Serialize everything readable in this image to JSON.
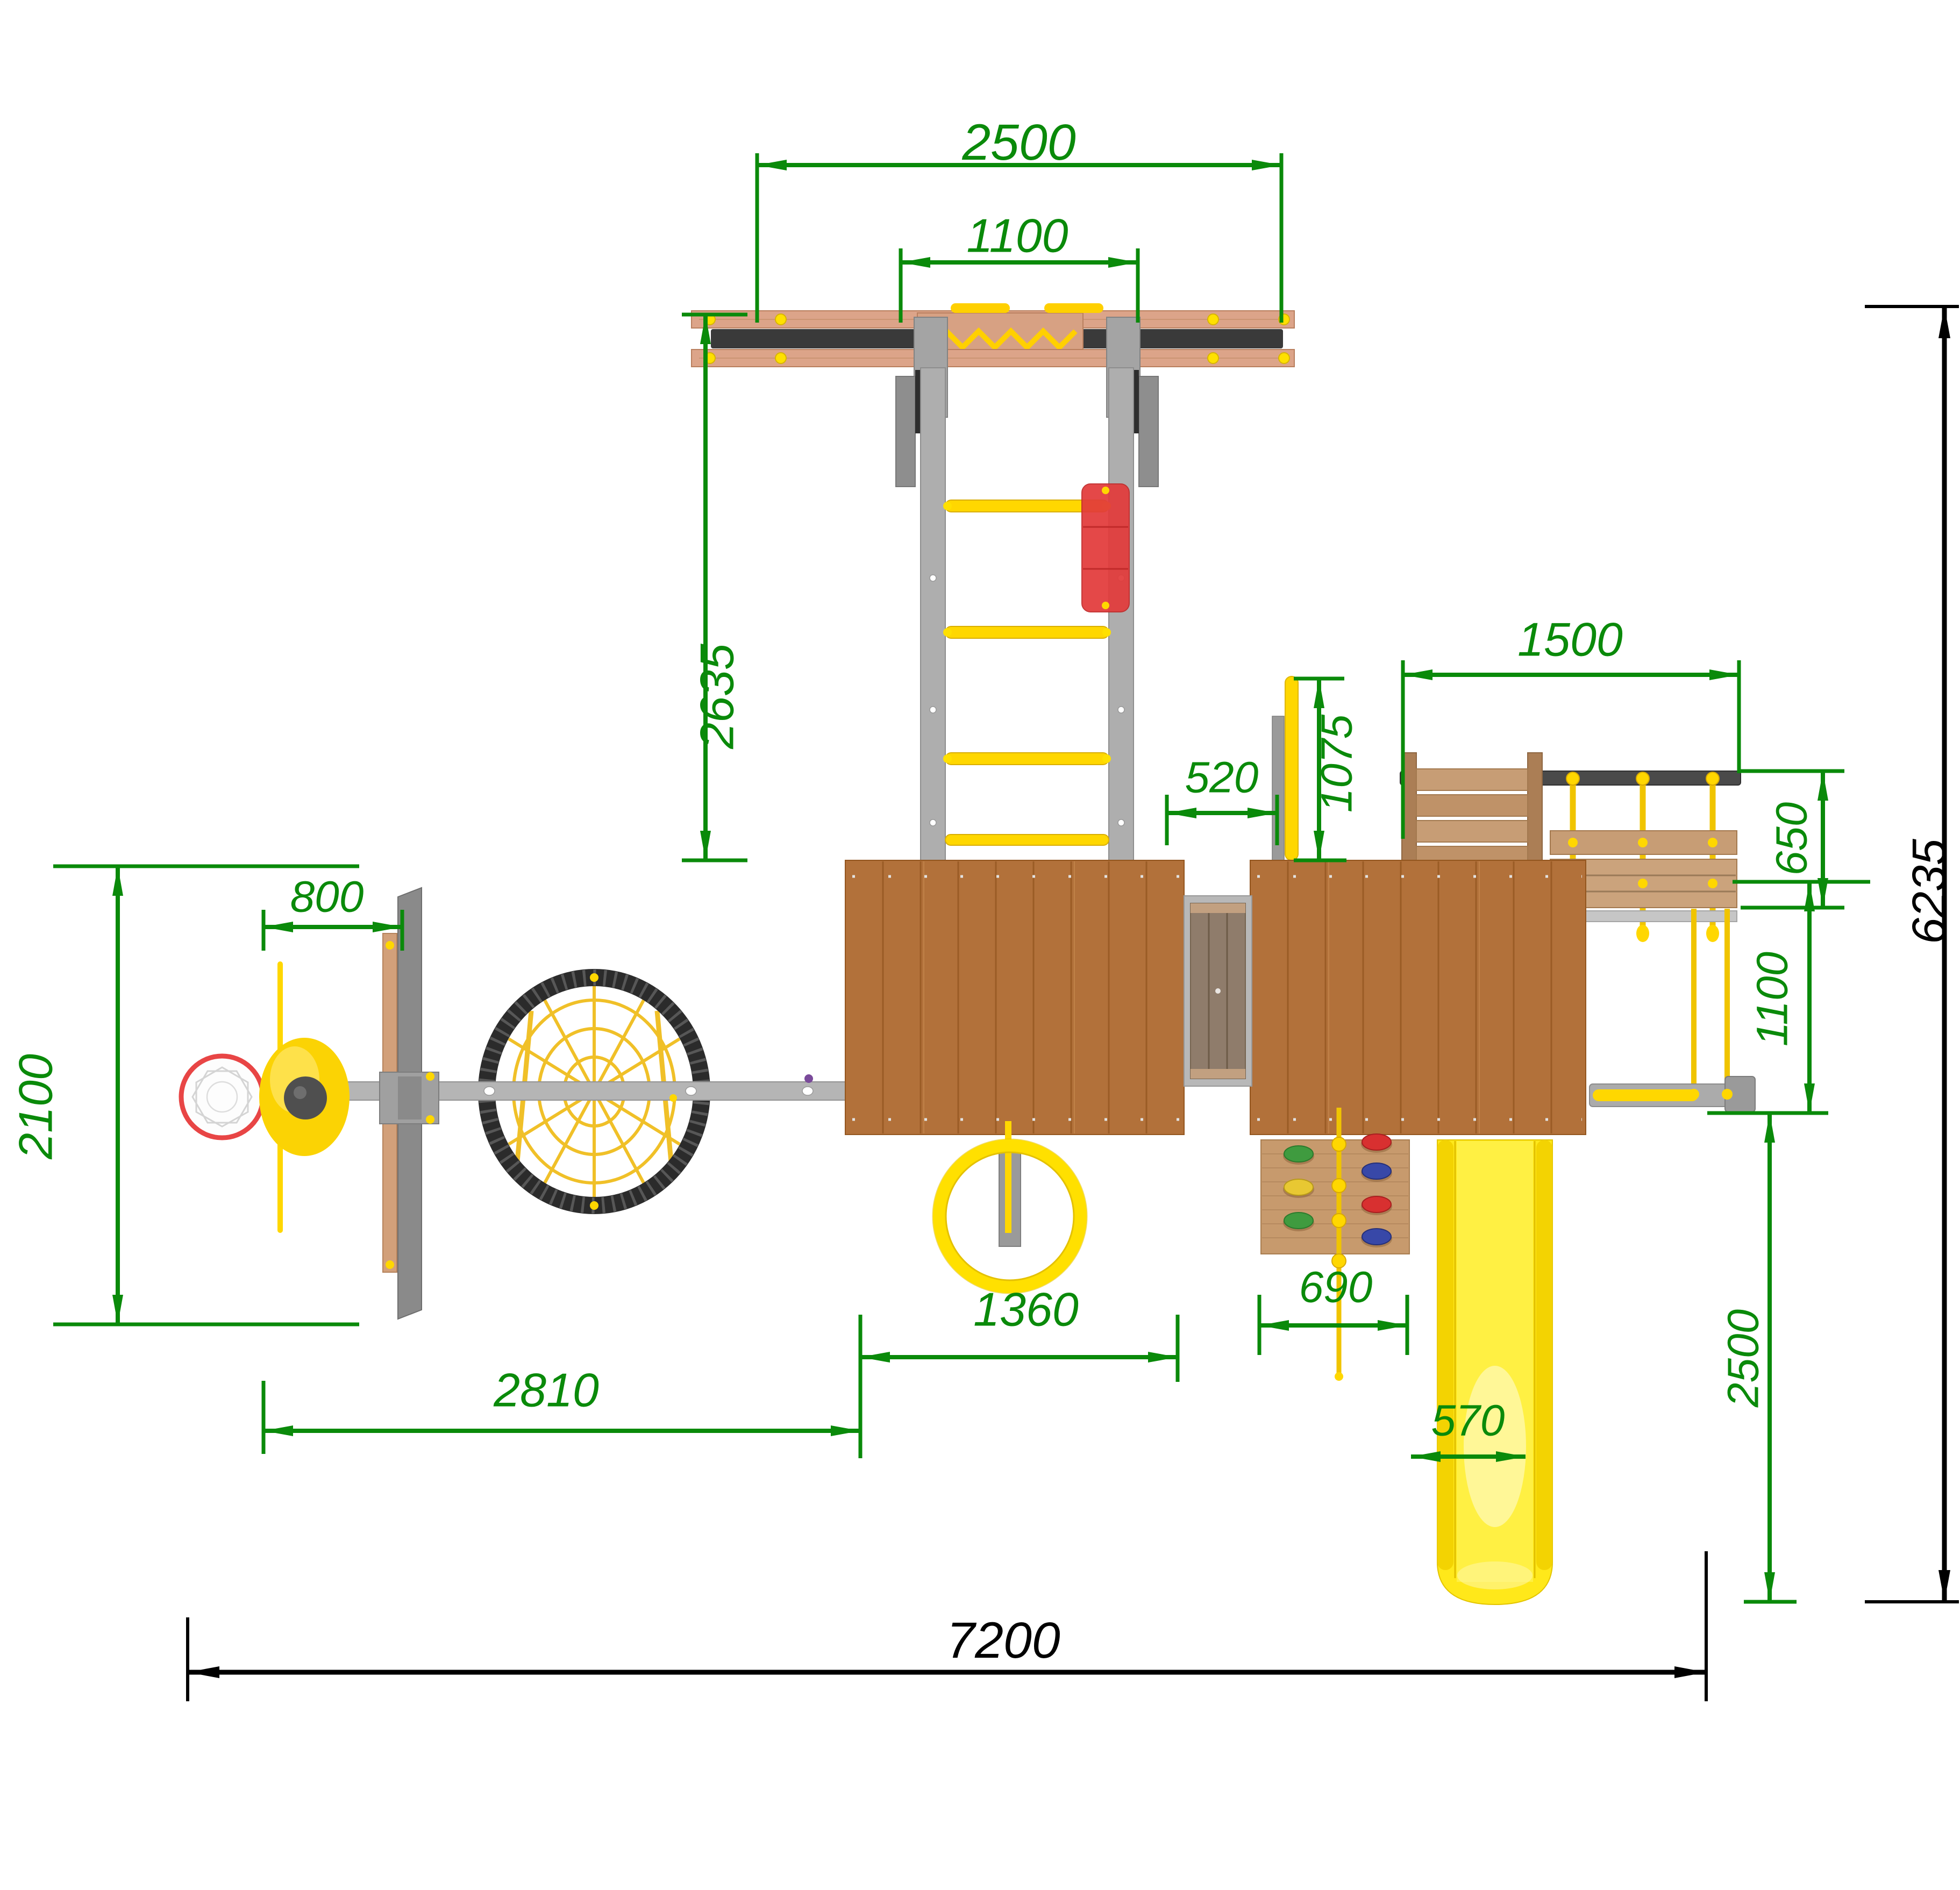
{
  "drawing": {
    "name": "playground-complex-top-view-dimensioned-drawing",
    "dims": {
      "top_width": "2500",
      "ladder_span": "1100",
      "ladder_length": "2635",
      "upper_right_width": "1500",
      "pole_offset": "1075",
      "walkway_gap": "520",
      "rope_ladder_depth": "650",
      "hoop_offset": "800",
      "left_zone_depth": "2100",
      "left_zone_width": "2810",
      "ring_offset": "1360",
      "climb_wall_width": "690",
      "slide_width": "570",
      "swing_zone_depth": "1100",
      "slide_zone_depth": "2500",
      "overall_width": "7200",
      "overall_depth": "6235"
    },
    "palette": {
      "dimension_green": "#0a8a0a",
      "dimension_black": "#000000",
      "platform_wood": "#b2713a",
      "board_wood": "#d9a484",
      "slat_wood": "#c79d75",
      "metal_gray": "#ababab",
      "dark_beam": "#3a3a3a",
      "equipment_yellow": "#ffd700",
      "slide_yellow": "#ffe81a",
      "grip_red": "#e23b3b",
      "net_yellow": "#f0c028",
      "web_ring_black": "#2b2b2b",
      "hold_green": "#3f9b3f",
      "hold_blue": "#3848a8",
      "hold_red": "#d83030",
      "hold_yellow": "#e8c832",
      "hoop_red": "#e84545",
      "rope_purple": "#7a4a9a"
    }
  }
}
